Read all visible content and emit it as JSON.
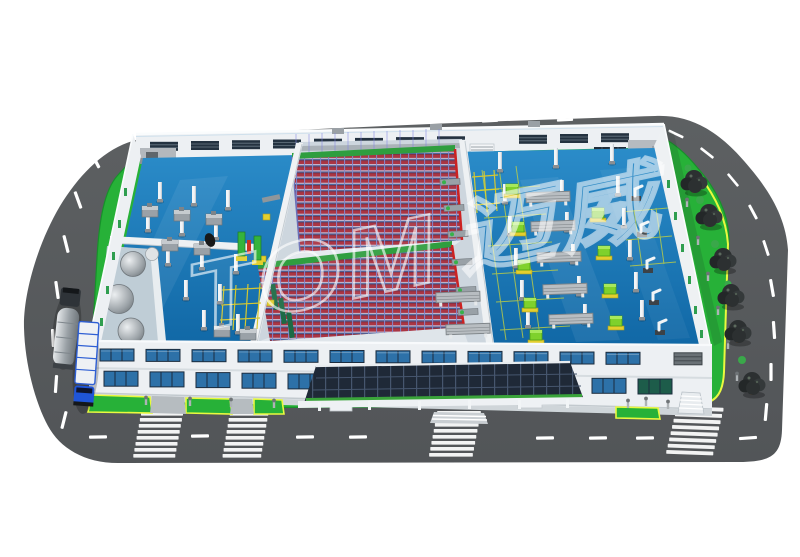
{
  "scene": {
    "title": "Aerial 3D rendering of a smart factory with cutaway roof",
    "watermark": {
      "text": "TOM",
      "suffix": "迈威"
    }
  },
  "palette": {
    "road": "#595c5e",
    "roadDark": "#525558",
    "roadMark": "#ffffff",
    "lawn": "#27b138",
    "lawnEdge": "#17912a",
    "yellowLine": "#e9f93f",
    "floor": "#1878b8",
    "floorLight": "#3f97cf",
    "wall": "#edf0f3",
    "wallShade": "#c9d1d7",
    "windowBlue": "#2d71a8",
    "windowDark": "#1b2c3e",
    "backWin": "#243240",
    "rackRed": "#b02629",
    "rackBlue": "#3b5e92",
    "rackPurple": "#8087cc",
    "rackGreen": "#2f9e3f",
    "canopy": "#1f2937",
    "canopyLine": "#46566e",
    "machineGray": "#9aa1a7",
    "lime": "#7fd12c",
    "palletYellow": "#e3cf2e",
    "treeDark": "#2c3031",
    "truckBlue": "#2e5fd4",
    "tanker": "#aab1b6"
  },
  "facility": {
    "zones": [
      {
        "name": "machining-area",
        "position": "left"
      },
      {
        "name": "asrs-racking-warehouse",
        "position": "center",
        "rack_blocks": 2
      },
      {
        "name": "assembly-area",
        "position": "right",
        "workbenches": 7,
        "robot_stations": 5
      },
      {
        "name": "tank-room",
        "position": "front-left",
        "tanks": 3
      }
    ],
    "vehicles": [
      {
        "type": "tanker-truck",
        "color": "silver"
      },
      {
        "type": "cargo-truck",
        "color": "blue-white"
      }
    ],
    "roads": {
      "type": "perimeter-loop",
      "crosswalks": 4
    },
    "landscaping": {
      "trees_right_lawn": 6,
      "front_lawn_patches": 4
    }
  }
}
